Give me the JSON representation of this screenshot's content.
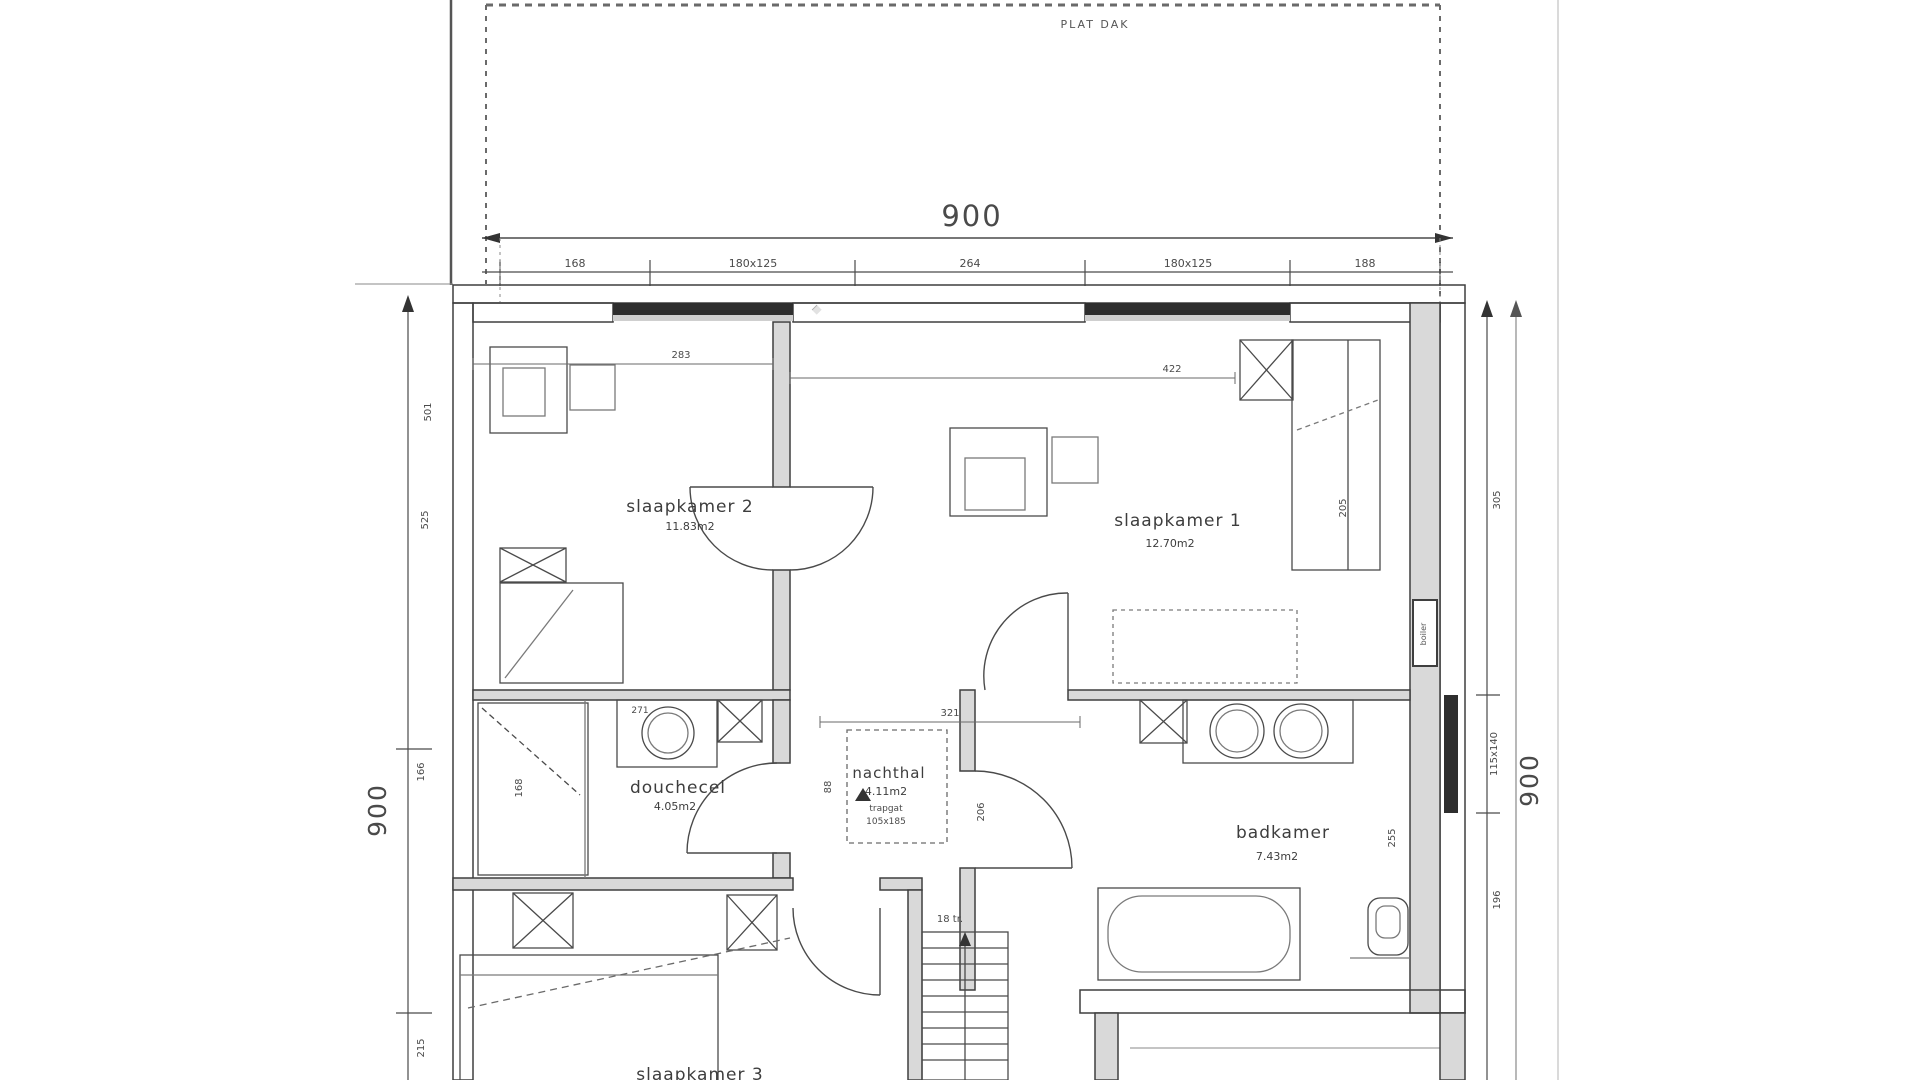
{
  "roof": {
    "label": "PLAT DAK"
  },
  "overall_dimensions": {
    "top": "900",
    "left": "900",
    "right": "900"
  },
  "top_dimension_row": [
    "168",
    "180x125",
    "264",
    "180x125",
    "188"
  ],
  "left_dimension_chain": [
    "525",
    "166",
    "215"
  ],
  "right_dimension_chain": [
    "305",
    "115x140",
    "196"
  ],
  "rooms": {
    "slaapkamer2": {
      "name": "slaapkamer 2",
      "area": "11.83m2",
      "width_dim": "283",
      "height_dim": "501"
    },
    "slaapkamer1": {
      "name": "slaapkamer 1",
      "area": "12.70m2",
      "width_dim": "422",
      "wardrobe_dim": "205"
    },
    "douchecel": {
      "name": "douchecel",
      "area": "4.05m2",
      "counter_dim": "271",
      "shower_dim": "168"
    },
    "nachthal": {
      "name": "nachthal",
      "area": "4.11m2",
      "trapgat_label": "trapgat",
      "trapgat_size": "105x185",
      "width_dim": "321",
      "wall_dim": "88",
      "side_dim": "206"
    },
    "badkamer": {
      "name": "badkamer",
      "area": "7.43m2",
      "side_dim": "255"
    },
    "slaapkamer3": {
      "name": "slaapkamer 3"
    }
  },
  "stairs": {
    "label": "18 tr."
  },
  "equipment": {
    "boiler": "boiler"
  }
}
